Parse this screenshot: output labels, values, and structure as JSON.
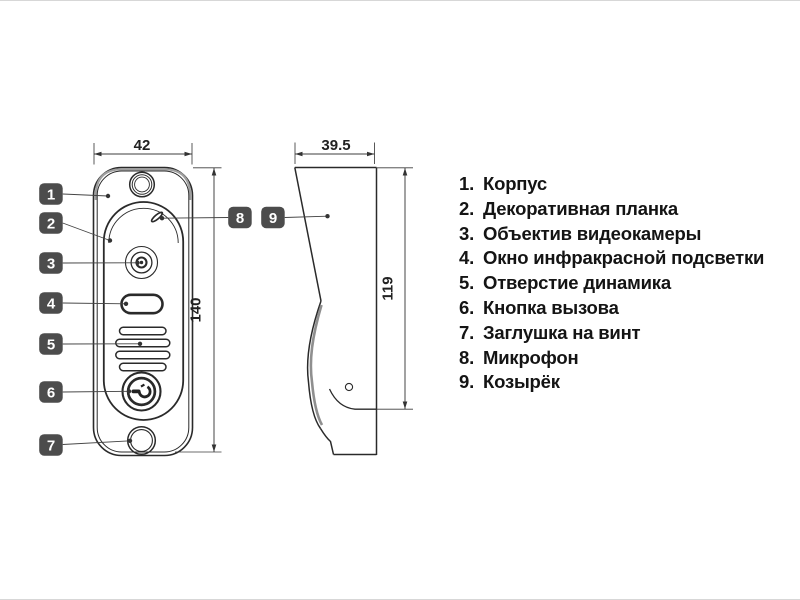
{
  "dims": {
    "front_width": "42",
    "front_height": "140",
    "side_depth": "39.5",
    "side_height": "119"
  },
  "callouts": [
    "1",
    "2",
    "3",
    "4",
    "5",
    "6",
    "7",
    "8",
    "9"
  ],
  "legend": {
    "items": [
      {
        "num": "1.",
        "label": "Корпус"
      },
      {
        "num": "2.",
        "label": "Декоративная планка"
      },
      {
        "num": "3.",
        "label": "Объектив видеокамеры"
      },
      {
        "num": "4.",
        "label": "Окно инфракрасной подсветки"
      },
      {
        "num": "5.",
        "label": "Отверстие динамика"
      },
      {
        "num": "6.",
        "label": "Кнопка вызова"
      },
      {
        "num": "7.",
        "label": "Заглушка на винт"
      },
      {
        "num": "8.",
        "label": "Микрофон"
      },
      {
        "num": "9.",
        "label": "Козырёк"
      }
    ]
  },
  "colors": {
    "outline": "#2a2a2a",
    "dimension_line": "#3c3c3c",
    "badge": "#4c4c4c",
    "badge_text": "#ffffff",
    "background": "#ffffff"
  }
}
